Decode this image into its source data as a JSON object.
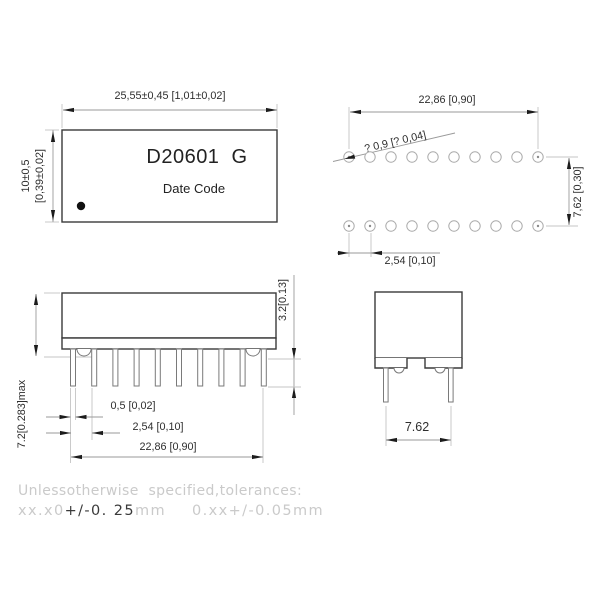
{
  "drawing": {
    "top_view": {
      "part_number": "D20601  G",
      "date_code": "Date Code",
      "width_dim": "25,55±0,45 [1,01±0,02]",
      "height_dim_mm": "10±0,5",
      "height_dim_in": "[0,39±0,02]"
    },
    "hole_view": {
      "span_dim": "22,86 [0,90]",
      "hole_dia_dim": "? 0,9 [? 0,04]",
      "row_spacing_dim": "7,62 [0,30]",
      "pitch_dim": "2,54 [0,10]"
    },
    "side_view": {
      "standoff_dim": "3.2[0.13]",
      "max_height_dim": "7.2[0.283]max",
      "pin_width_dim": "0,5 [0,02]",
      "pitch_dim": "2,54 [0,10]",
      "span_dim": "22,86 [0,90]"
    },
    "end_view": {
      "pin_spacing_dim": "7.62"
    },
    "tolerance_note": {
      "line1": "Unlessotherwise  specified,tolerances:",
      "line2_prefix": "xx.x0",
      "line2_highlight": "+/-0. 25",
      "line2_unit": "mm",
      "line2_second": "0.xx+/-0.05mm"
    },
    "colors": {
      "outline": "#3a3a3a",
      "dimension": "#9a9a9a",
      "extension": "#c4c4c4",
      "text": "#2e2e2e",
      "note_gray": "#cacaca",
      "note_dark": "#3a3a3a"
    }
  }
}
